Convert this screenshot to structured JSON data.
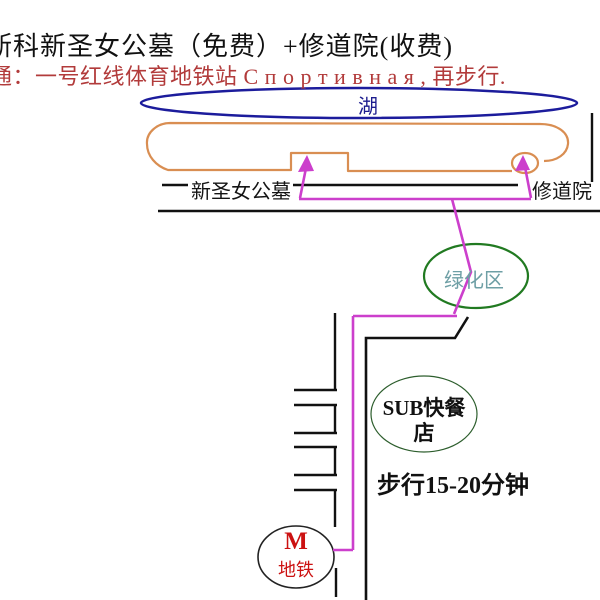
{
  "title": {
    "line1": "斯科新圣女公墓（免费）+修道院(收费)",
    "line2": "通：一号红线体育地铁站 С п о р т и в н а я , 再步行."
  },
  "map": {
    "lake_label": "湖",
    "cemetery_label": "新圣女公墓",
    "monastery_label": "修道院",
    "green_area_label": "绿化区",
    "restaurant_label_line1": "SUB快餐",
    "restaurant_label_line2": "店",
    "walk_time_label": "步行15-20分钟",
    "metro": {
      "letter": "M",
      "label": "地铁"
    }
  },
  "colors": {
    "title_text": "#111111",
    "transit_note_red": "#b23b3b",
    "lake_blue": "#1c1c9c",
    "cemetery_outline_orange": "#d98e52",
    "green_area_green": "#217a21",
    "green_area_text_teal": "#6e9fa5",
    "restaurant_outline_green": "#2d5e2d",
    "route_magenta": "#cc3fcc",
    "road_black": "#111111",
    "metro_red": "#cc1111"
  }
}
